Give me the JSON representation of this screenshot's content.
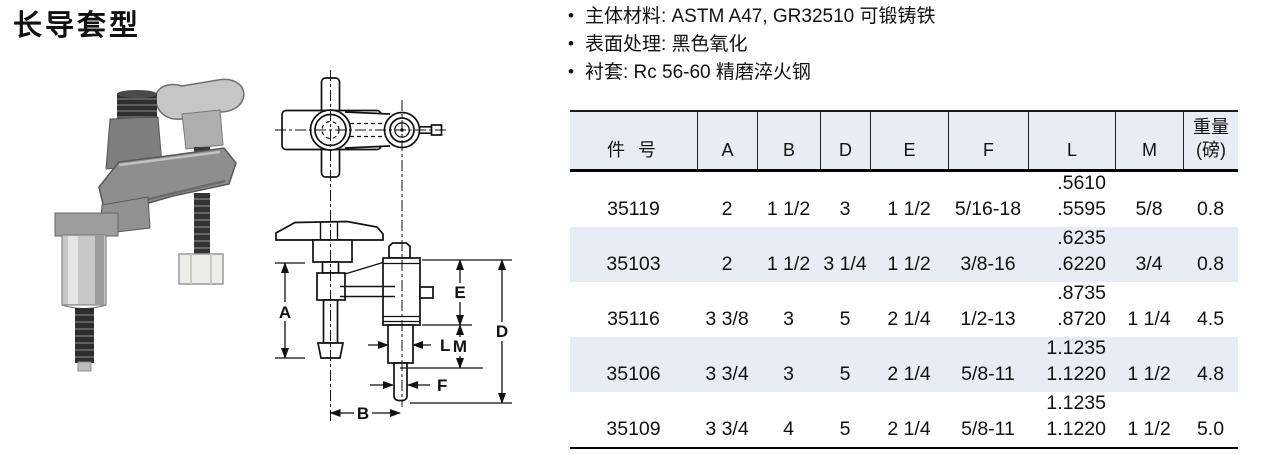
{
  "page": {
    "title": "长导套型"
  },
  "bullet_glyph": "•",
  "specs": {
    "items": [
      "主体材料: ASTM A47, GR32510 可锻铸铁",
      "表面处理: 黑色氧化",
      "衬套: Rc 56-60 精磨淬火钢"
    ]
  },
  "drawing": {
    "labels": {
      "A": "A",
      "B": "B",
      "D": "D",
      "E": "E",
      "F": "F",
      "L": "L",
      "M": "M"
    }
  },
  "table": {
    "headers": {
      "part": "件 号",
      "A": "A",
      "B": "B",
      "D": "D",
      "E": "E",
      "F": "F",
      "L": "L",
      "M": "M",
      "weight1": "重量",
      "weight2": "(磅)"
    },
    "rows": [
      {
        "part": "35119",
        "A": "2",
        "B": "1 1/2",
        "D": "3",
        "E": "1 1/2",
        "F": "5/16-18",
        "L_upper": ".5610",
        "L_lower": ".5595",
        "M": "5/8",
        "weight": "0.8",
        "shaded": false
      },
      {
        "part": "35103",
        "A": "2",
        "B": "1 1/2",
        "D": "3 1/4",
        "E": "1 1/2",
        "F": "3/8-16",
        "L_upper": ".6235",
        "L_lower": ".6220",
        "M": "3/4",
        "weight": "0.8",
        "shaded": true
      },
      {
        "part": "35116",
        "A": "3 3/8",
        "B": "3",
        "D": "5",
        "E": "2 1/4",
        "F": "1/2-13",
        "L_upper": ".8735",
        "L_lower": ".8720",
        "M": "1 1/4",
        "weight": "4.5",
        "shaded": false
      },
      {
        "part": "35106",
        "A": "3 3/4",
        "B": "3",
        "D": "5",
        "E": "2 1/4",
        "F": "5/8-11",
        "L_upper": "1.1235",
        "L_lower": "1.1220",
        "M": "1 1/2",
        "weight": "4.8",
        "shaded": true
      },
      {
        "part": "35109",
        "A": "3 3/4",
        "B": "4",
        "D": "5",
        "E": "2 1/4",
        "F": "5/8-11",
        "L_upper": "1.1235",
        "L_lower": "1.1220",
        "M": "1 1/2",
        "weight": "5.0",
        "shaded": false
      }
    ]
  },
  "colors": {
    "band": "#e8ecf5",
    "ink": "#111111"
  }
}
